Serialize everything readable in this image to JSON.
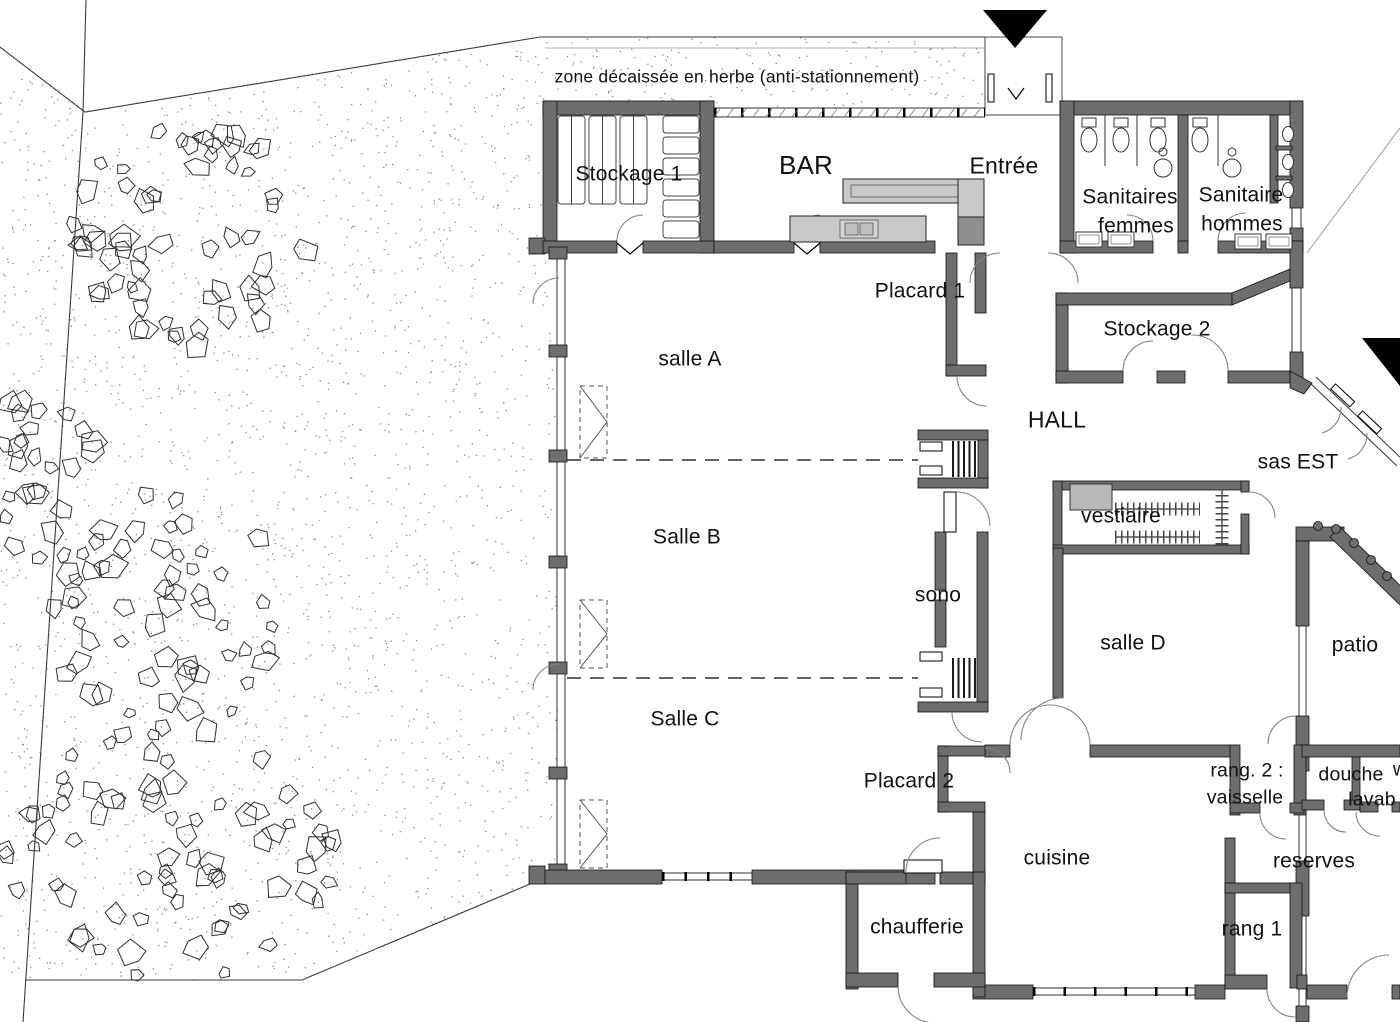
{
  "doc": {
    "type": "architectural-floor-plan",
    "site_note": "zone décaissée en herbe (anti-stationnement)"
  },
  "labels": {
    "site_note": "zone décaissée en herbe (anti-stationnement)",
    "stockage1": "Stockage 1",
    "bar": "BAR",
    "entree": "Entrée",
    "sanitaires_femmes_l1": "Sanitaires",
    "sanitaires_femmes_l2": "femmes",
    "sanitaire_hommes_l1": "Sanitaire",
    "sanitaire_hommes_l2": "hommes",
    "placard1": "Placard 1",
    "stockage2": "Stockage 2",
    "salle_a": "salle A",
    "hall": "HALL",
    "sas_est": "sas EST",
    "vestiaire": "vestiaire",
    "salle_b": "Salle B",
    "sono": "sono",
    "salle_d": "salle D",
    "patio": "patio",
    "salle_c": "Salle C",
    "placard2": "Placard 2",
    "rang2_l1": "rang. 2 :",
    "rang2_l2": "vaisselle",
    "douche": "douche",
    "douche_cut": "w",
    "lavabo_cut": "lavab",
    "reserves": "reserves",
    "cuisine": "cuisine",
    "chaufferie": "chaufferie",
    "rang1": "rang 1"
  },
  "markers": {
    "north_entrance_arrow": "filled-triangle-down",
    "east_entrance_arrow": "filled-triangle-corner"
  },
  "colors": {
    "paper": "#ffffff",
    "wall": "#6e6e6e",
    "counter": "#c9c9c9",
    "counter_dark": "#8f8f8f",
    "ink": "#111111",
    "stipple": "#8c8c8c"
  }
}
